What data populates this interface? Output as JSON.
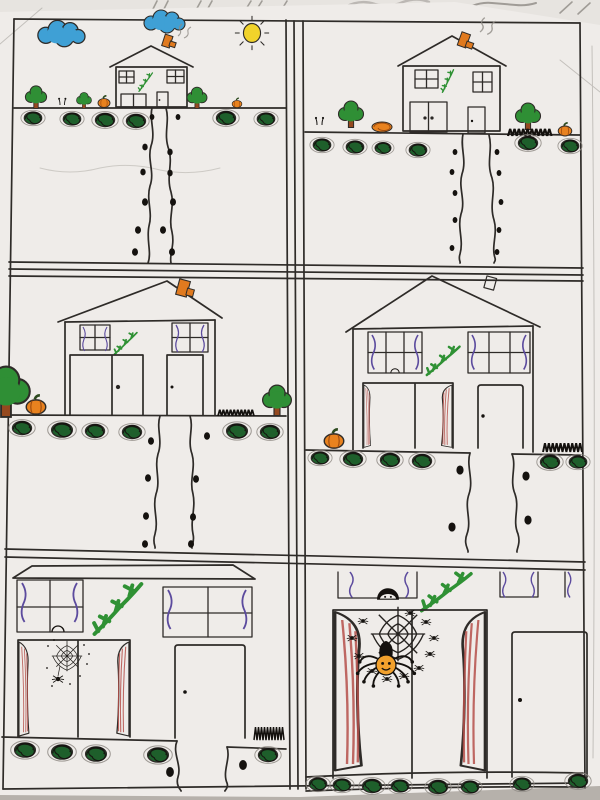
{
  "meta": {
    "alt": "Photograph of a child's six-panel marker drawing on white paper: each panel zooms closer in on a two-story house decorated for Halloween, ending on a window full of spiders with a pumpkin-faced spider."
  },
  "colors": {
    "paper": "#efece9",
    "backsheet": "#e7e4e0",
    "table": "#b6b1ab",
    "ink": "#2e2b28",
    "pencil": "#8f8b85",
    "cloud-blue": "#3fa0d5",
    "sun-yellow": "#f1d32b",
    "tree-green": "#2f8f35",
    "bush-green": "#1e5f2b",
    "trunk-brown": "#95491f",
    "pumpkin-orange": "#e8821f",
    "chimney-orange": "#e07a1f",
    "vine-green": "#2f9134",
    "curtain-purple": "#5c4b9e",
    "curtain-red": "#b5504a",
    "spider-black": "#17130f",
    "spider-face-orange": "#f2a12d"
  },
  "scene": {
    "medium": "hand-drawn comic strip in marker and pencil on paper",
    "layout": "2 columns x 3 rows of ruled panels",
    "theme": "progressive zoom toward a house with Halloween details",
    "panels": [
      {
        "position": "top-left",
        "view": "house seen from far away",
        "elements": [
          "two blue clouds",
          "yellow sun",
          "orange chimney with pencil smoke",
          "two four-pane windows",
          "green vine on wall",
          "garage door",
          "front door",
          "three trees",
          "two orange pumpkins",
          "row of dark green bushes",
          "winding path with black stepping stones"
        ]
      },
      {
        "position": "top-right",
        "view": "house slightly closer",
        "elements": [
          "orange chimney with smoke",
          "two four-pane windows",
          "green vine",
          "double garage door",
          "front door with knob",
          "two trees",
          "orange shrub",
          "sprouts",
          "pumpkin",
          "black grass tuft",
          "bushes",
          "winding stone path"
        ]
      },
      {
        "position": "middle-left",
        "view": "house closer, fills panel",
        "elements": [
          "orange chimney",
          "two curtained four-pane windows",
          "green vine",
          "double garage door",
          "front door with knob",
          "large tree at edge",
          "pumpkin",
          "small tree",
          "grass tuft",
          "bushes",
          "winding stone path"
        ]
      },
      {
        "position": "middle-right",
        "view": "house facade close-up",
        "elements": [
          "roof with outlined chimney",
          "two six-pane windows with purple curtains",
          "tiny head peeking in window",
          "large green vine",
          "opening with red striped curtains",
          "front door with knob",
          "pumpkin",
          "black grass tuft",
          "bushes",
          "widening stone path"
        ]
      },
      {
        "position": "bottom-left",
        "view": "very close: doorway and windows",
        "elements": [
          "roof edge in perspective",
          "two curtained upper windows",
          "tiny head peeking",
          "large green vine",
          "opening with red striped curtains",
          "small spider web with hanging spider and flies",
          "front door with knob",
          "grass tuft",
          "bushes",
          "stone path"
        ]
      },
      {
        "position": "bottom-right",
        "view": "closest: haunted window",
        "elements": [
          "bottoms of upper windows with purple curtains",
          "child peeking over sill",
          "green vine",
          "large red striped curtains",
          "big spider web",
          "many small spiders",
          "large spider with orange jack-o-lantern face",
          "front door with knob",
          "planter row of bushes"
        ]
      }
    ]
  }
}
